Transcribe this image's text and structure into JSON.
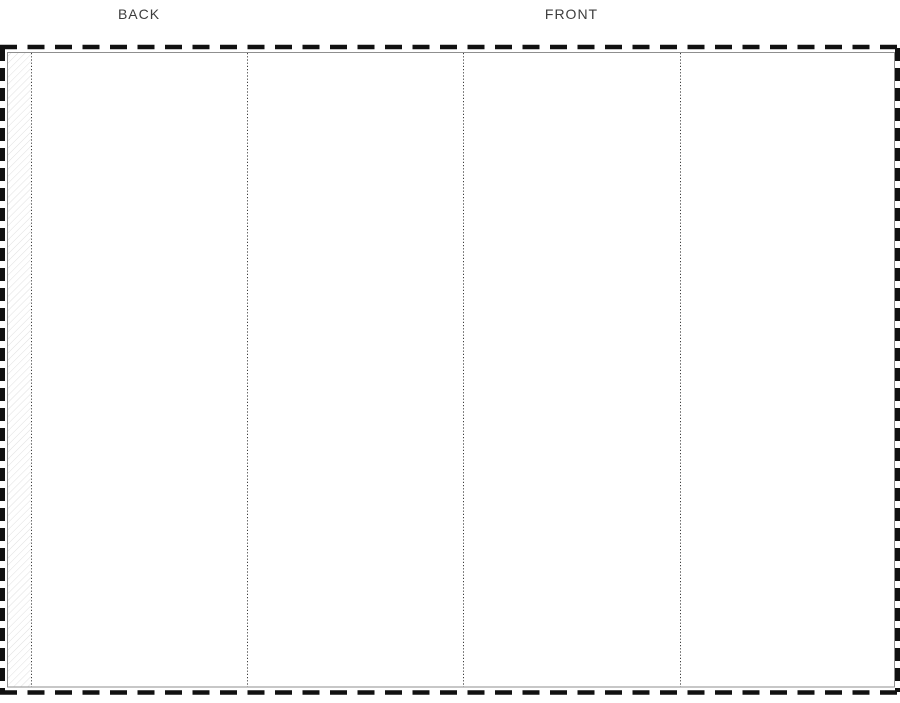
{
  "labels": {
    "back_panel": "BACK",
    "front_panel": "FRONT"
  },
  "colors": {
    "background": "#ffffff",
    "cut_line": "#111111",
    "edge_line": "#8f8f8f",
    "fold_line": "#3f3f3f",
    "glue_hatch": "#e0e0e0",
    "label_text": "#3d3d3d"
  },
  "structure": {
    "panels": [
      {
        "name": "glue-flap",
        "label": ""
      },
      {
        "name": "back-panel",
        "label": "BACK"
      },
      {
        "name": "left-side-panel",
        "label": ""
      },
      {
        "name": "front-panel",
        "label": "FRONT"
      },
      {
        "name": "right-side-panel",
        "label": ""
      }
    ],
    "fold_line_positions_px": [
      31,
      247,
      463,
      680
    ],
    "outer_border_style": "dashed-cut-line",
    "fold_line_style": "dotted"
  }
}
